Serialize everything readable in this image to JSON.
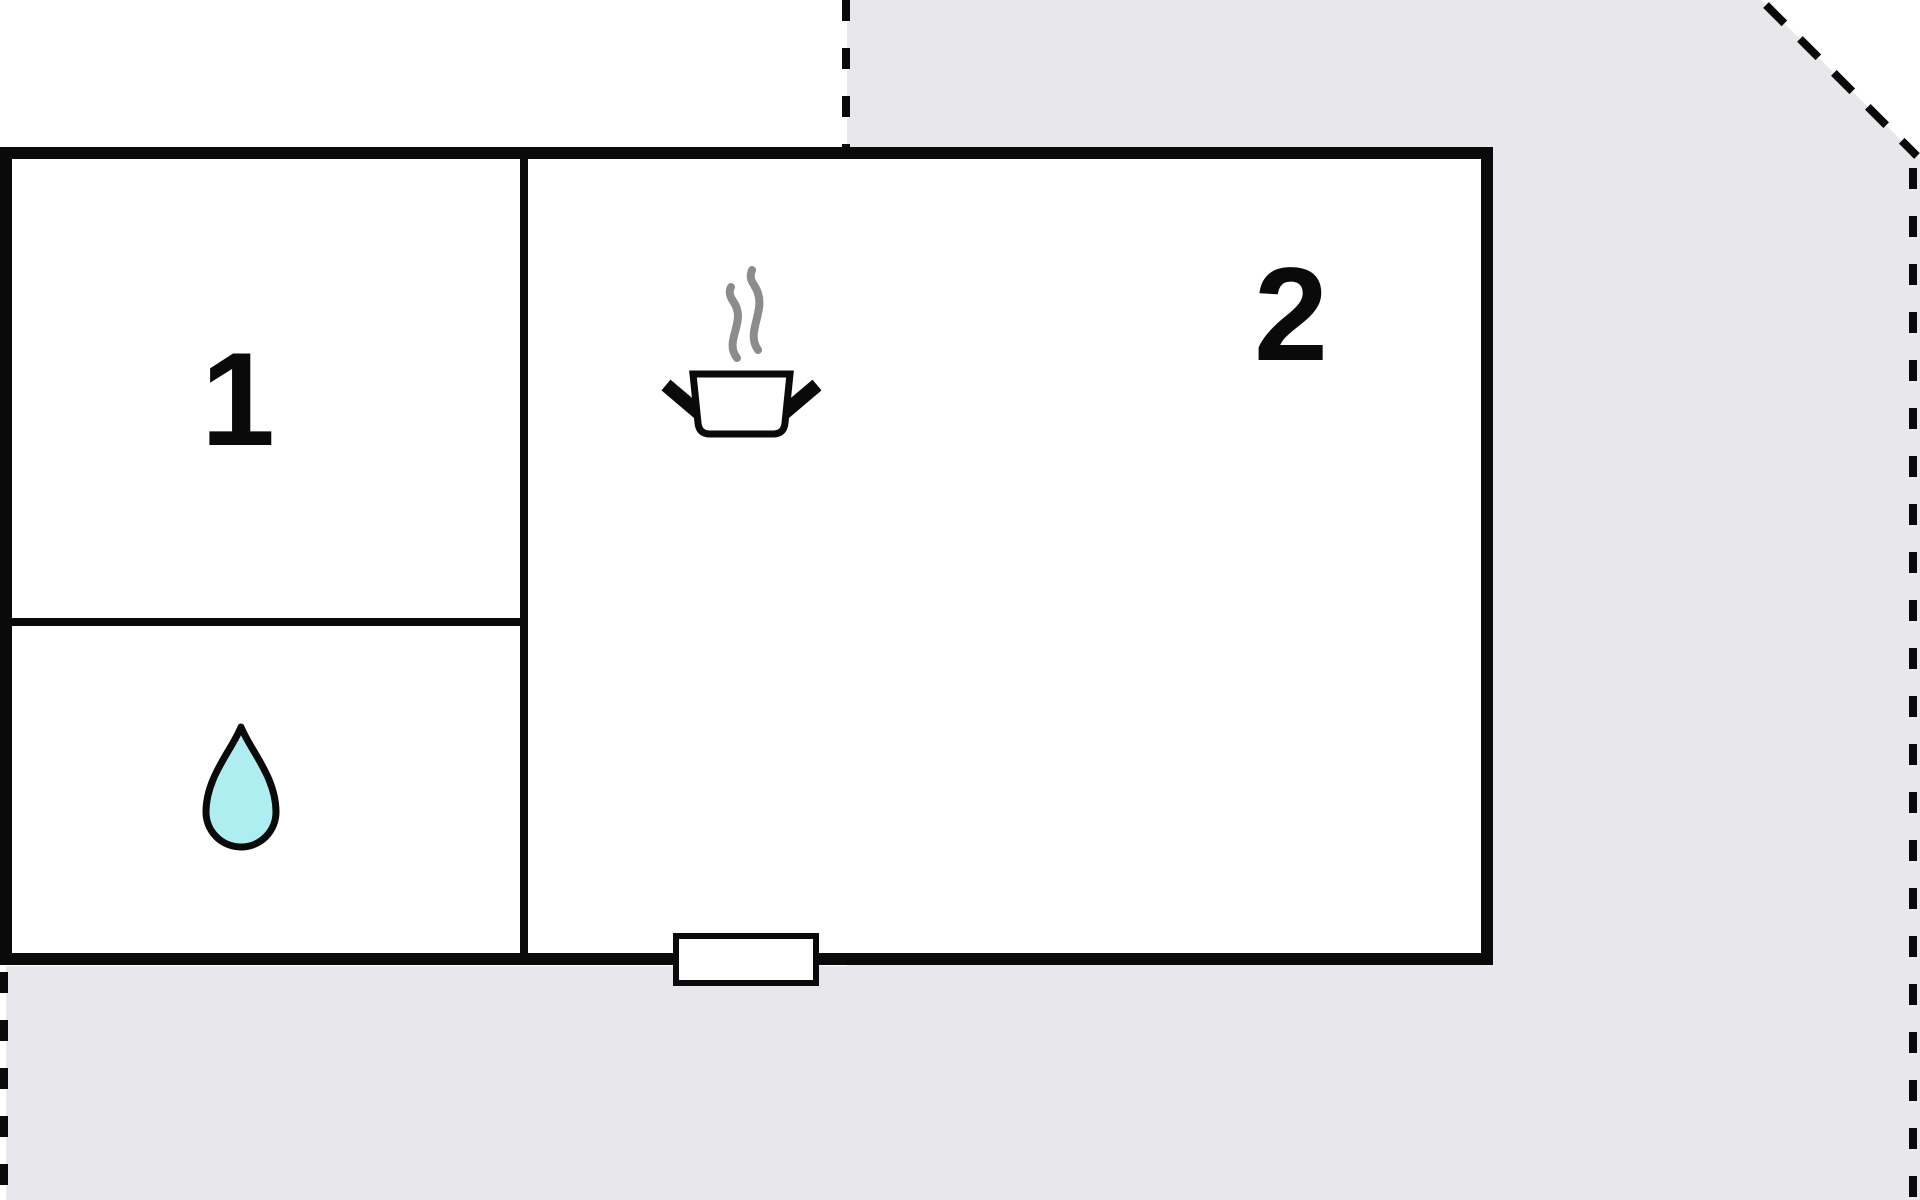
{
  "rooms": [
    {
      "number": "1"
    },
    {
      "number": "2"
    }
  ],
  "icons": {
    "kitchen": "steaming-pot-icon",
    "bathroom": "water-drop-icon",
    "entrance": "door-opening"
  },
  "colors": {
    "parcel_fill": "#e8e8ec",
    "boundary_dash": "#0a0a0a",
    "wall": "#0a0a0a",
    "room_fill": "#ffffff",
    "steam_stroke": "#8c8c8c",
    "drop_fill": "#aeeef0",
    "drop_stroke": "#0a0a0a",
    "label_color": "#0a0a0a"
  }
}
